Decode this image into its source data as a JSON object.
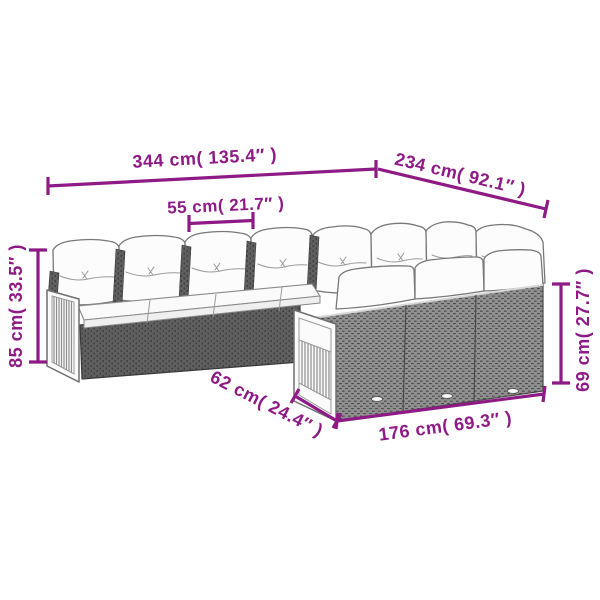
{
  "diagram": {
    "subject": "rattan corner sofa set with cushions — product dimension line drawing",
    "accent_color": "#8e1a85",
    "colors": {
      "wicker_dark": "#5f5f5f",
      "wicker_light": "#909090",
      "cushion": "#fcfcfc",
      "outline_gray": "#787878",
      "wood_panel": "#fbfbfb",
      "background": "#ffffff"
    },
    "measurements": {
      "total_width": {
        "label": "344 cm( 135.4″ )",
        "cm": 344,
        "inch": 135.4,
        "position": "top-left"
      },
      "wing_depth": {
        "label": "234 cm( 92.1″ )",
        "cm": 234,
        "inch": 92.1,
        "position": "top-right"
      },
      "seat_width": {
        "label": "55 cm( 21.7″ )",
        "cm": 55,
        "inch": 21.7,
        "position": "above middle seat"
      },
      "back_height": {
        "label": "85 cm( 33.5″ )",
        "cm": 85,
        "inch": 33.5,
        "position": "left vertical"
      },
      "wing_back_height": {
        "label": "69 cm( 27.7″ )",
        "cm": 69,
        "inch": 27.7,
        "position": "right vertical"
      },
      "end_depth": {
        "label": "62 cm( 24.4″ )",
        "cm": 62,
        "inch": 24.4,
        "position": "bottom-left diagonal"
      },
      "wing_length": {
        "label": "176 cm( 69.3″ )",
        "cm": 176,
        "inch": 69.3,
        "position": "bottom"
      }
    }
  }
}
